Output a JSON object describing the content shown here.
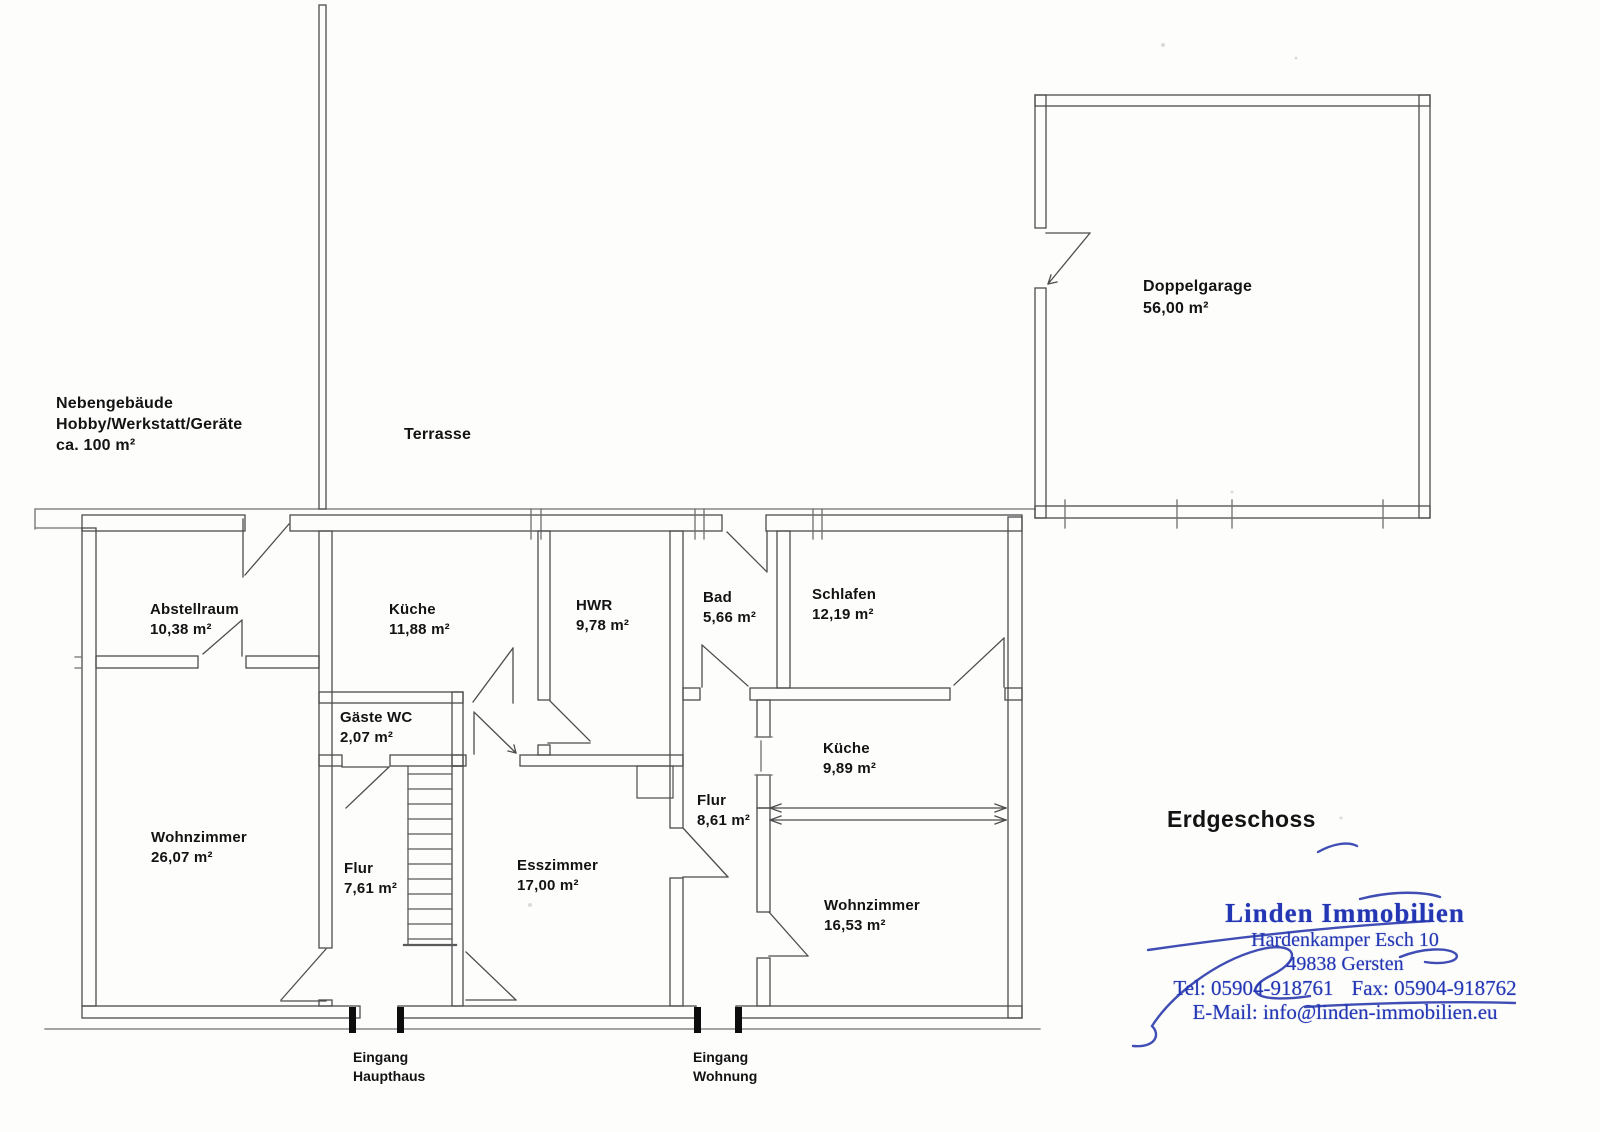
{
  "document": {
    "type": "floor-plan",
    "floor_label": "Erdgeschoss"
  },
  "outbuilding": {
    "line1": "Nebengebäude",
    "line2": "Hobby/Werkstatt/Geräte",
    "line3": "ca. 100 m²"
  },
  "terrace": {
    "label": "Terrasse"
  },
  "garage": {
    "label": "Doppelgarage",
    "area": "56,00 m²"
  },
  "rooms": [
    {
      "label": "Abstellraum",
      "area": "10,38 m²"
    },
    {
      "label": "Küche",
      "area": "11,88 m²"
    },
    {
      "label": "HWR",
      "area": "9,78 m²"
    },
    {
      "label": "Bad",
      "area": "5,66 m²"
    },
    {
      "label": "Schlafen",
      "area": "12,19 m²"
    },
    {
      "label": "Gäste WC",
      "area": "2,07 m²"
    },
    {
      "label": "Küche",
      "area": "9,89 m²"
    },
    {
      "label": "Flur",
      "area": "8,61 m²"
    },
    {
      "label": "Wohnzimmer",
      "area": "26,07 m²"
    },
    {
      "label": "Flur",
      "area": "7,61 m²"
    },
    {
      "label": "Esszimmer",
      "area": "17,00 m²"
    },
    {
      "label": "Wohnzimmer",
      "area": "16,53 m²"
    }
  ],
  "entrances": [
    {
      "line1": "Eingang",
      "line2": "Haupthaus"
    },
    {
      "line1": "Eingang",
      "line2": "Wohnung"
    }
  ],
  "stamp": {
    "company": "Linden Immobilien",
    "address": "Hardenkamper Esch 10",
    "city": "49838 Gersten",
    "tel": "Tel: 05904-918761",
    "fax": "Fax: 05904-918762",
    "email": "E-Mail: info@linden-immobilien.eu"
  },
  "colors": {
    "ink": "#4d4d4d",
    "label_ink": "#131313",
    "stamp_blue": "#2336b4"
  }
}
